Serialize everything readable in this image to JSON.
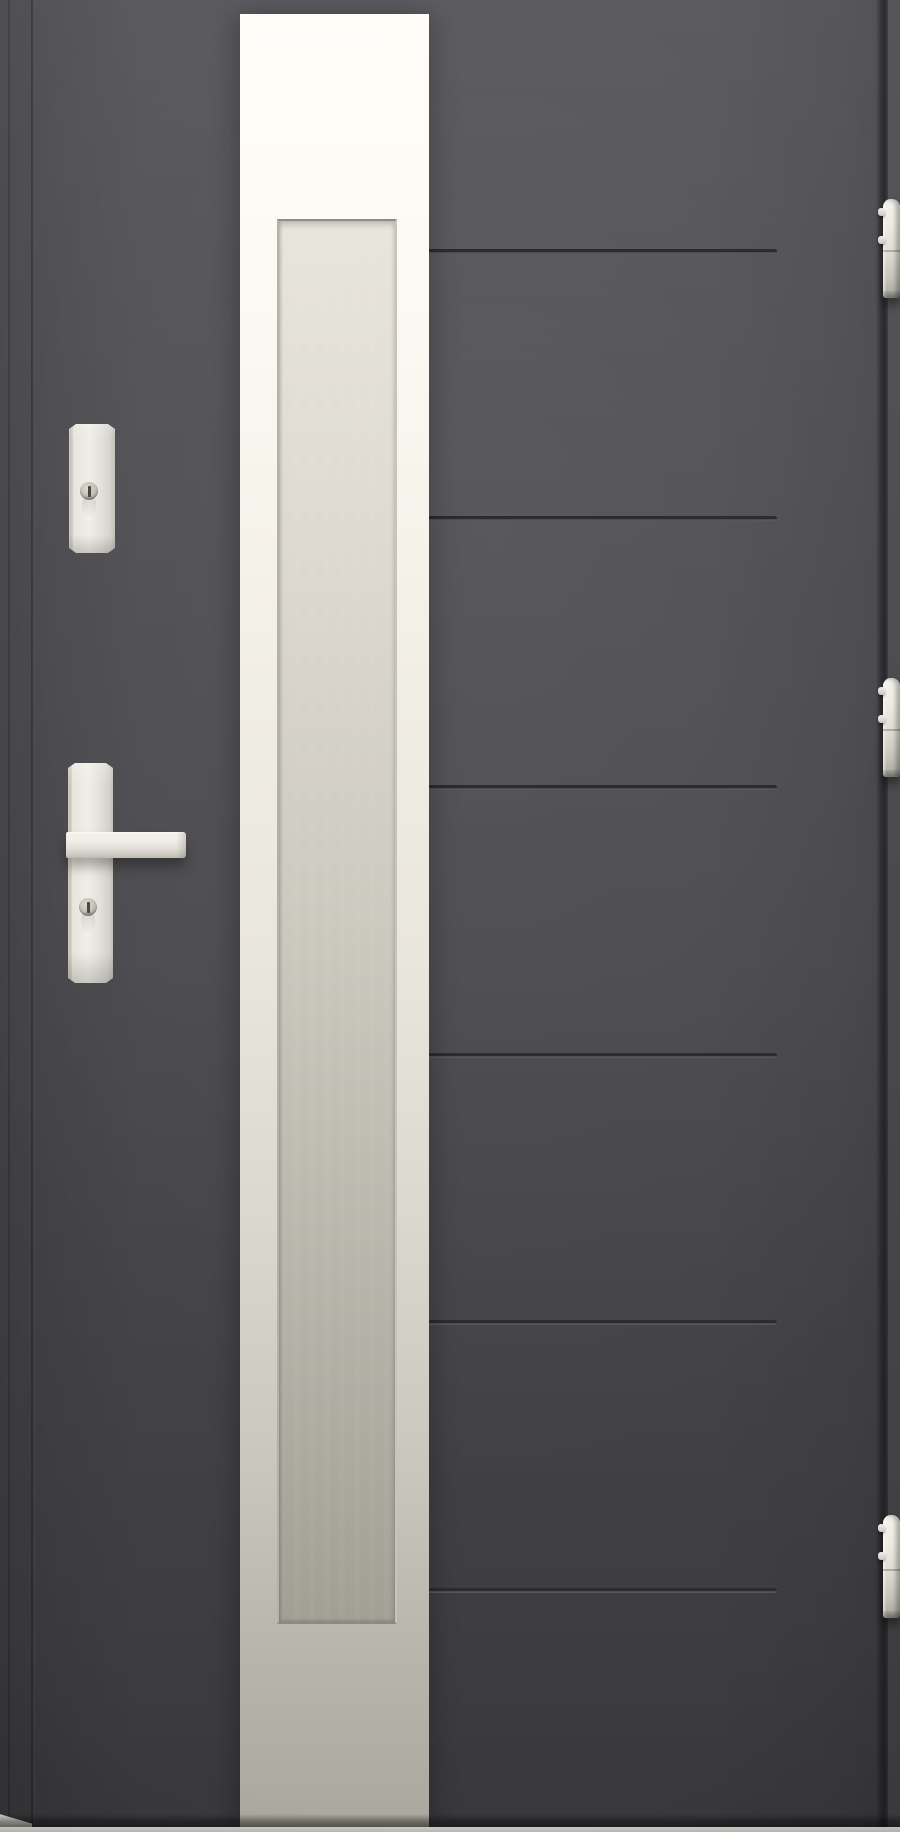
{
  "scene": {
    "subject": "anthracite-grey exterior entrance door with full-height frosted glass strip, cream lever handle, deadbolt escutcheon and three edge hinges",
    "width_px": 900,
    "height_px": 1832
  },
  "palette": {
    "door_top": "#59595d",
    "door_mid": "#4b4b4f",
    "door_bottom": "#38383b",
    "groove_dark": "#2c2c30",
    "groove_light": "#5d5d61",
    "frame_right_top": "#55555a",
    "frame_right_bottom": "#3b3b3f",
    "strip_top": "#fefdf8",
    "strip_mid": "#e9e6dd",
    "strip_bottom": "#aaa89e",
    "glass_top": "#e8e5dc",
    "glass_bottom": "#a29f95",
    "glass_bevel": "#8f8d85",
    "hardware_light": "#f0eee6",
    "hardware_mid": "#e7e5dd",
    "hardware_shadow": "#c2c0b8",
    "hardware_dark": "#8f8d85",
    "floor_light": "#cbc9c2"
  },
  "door": {
    "leaf": {
      "left_px": 33,
      "right_px": 879
    },
    "grooves": {
      "count": 6,
      "x_start_px": 429,
      "x_end_px": 777,
      "y_tops_px": [
        249,
        516,
        785,
        1053,
        1320,
        1588
      ]
    }
  },
  "glass_panel": {
    "strip": {
      "x_px": 240,
      "width_px": 189,
      "top_px": 14
    },
    "glazing": {
      "x_px": 277,
      "width_px": 116,
      "top_px": 219,
      "height_px": 1401
    }
  },
  "hardware": {
    "deadbolt_plate": {
      "x_px": 69,
      "top_px": 424,
      "width_px": 46,
      "height_px": 129,
      "cylinder_center_y_px": 491
    },
    "handle": {
      "plate": {
        "x_px": 68,
        "top_px": 763,
        "width_px": 45,
        "height_px": 220
      },
      "lever": {
        "x_px": 66,
        "top_px": 832,
        "width_px": 120,
        "height_px": 26
      },
      "cylinder_center_y_px": 907
    },
    "hinges": {
      "count": 3,
      "x_px": 883,
      "width_px": 17,
      "items": [
        {
          "top_px": 199,
          "height_px": 99
        },
        {
          "top_px": 678,
          "height_px": 99
        },
        {
          "top_px": 1515,
          "height_px": 103
        }
      ],
      "pin_offsets_px": [
        9,
        37
      ]
    }
  },
  "floor": {
    "shadow_top_px": 1814,
    "line_top_px": 1827
  }
}
